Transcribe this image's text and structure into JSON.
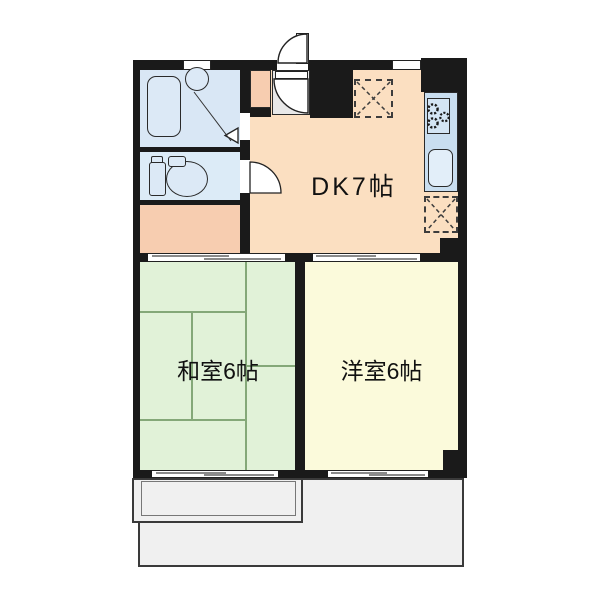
{
  "floor_plan": {
    "title": "apartment-floor-plan",
    "rooms": {
      "dk": {
        "label": "DK7帖",
        "color": "#fbdfc1"
      },
      "washitsu": {
        "label": "和室6帖",
        "color": "#e1f2d8"
      },
      "youshitsu": {
        "label": "洋室6帖",
        "color": "#fbfadb"
      },
      "bathroom": {
        "color": "#d9e7f5"
      },
      "toilet": {
        "color": "#dcebf7"
      },
      "hallway": {
        "color": "#f7cdb0"
      },
      "entry_closet": {
        "color": "#f7cdb0"
      },
      "entry_hall": {
        "color": "#e8e8e8"
      },
      "balcony": {
        "color": "#f0f0f0"
      }
    },
    "colors": {
      "wall": "#1a1a1a",
      "outline": "#222222",
      "fixture_fill": "#dce9f6",
      "counter_fill": "#c9def0",
      "stove_fill": "#d4e5f4",
      "sink_fill": "#e2eef9",
      "tatami_line": "#84a878",
      "balcony_border": "#3a3a3a",
      "background": "#ffffff"
    },
    "icons": {
      "bathtub": "rounded-rectangle",
      "washbasin": "circle",
      "toilet": "tank-and-bowl",
      "gas_stove": "three-burner-circles",
      "kitchen_sink": "rounded-rectangle",
      "door_swing": "quarter-arc",
      "door_triangle": "left-pointing-triangle",
      "sliding_door": "double-offset-lines",
      "window": "white-bar",
      "appliance_space": "dashed-x-box"
    }
  }
}
